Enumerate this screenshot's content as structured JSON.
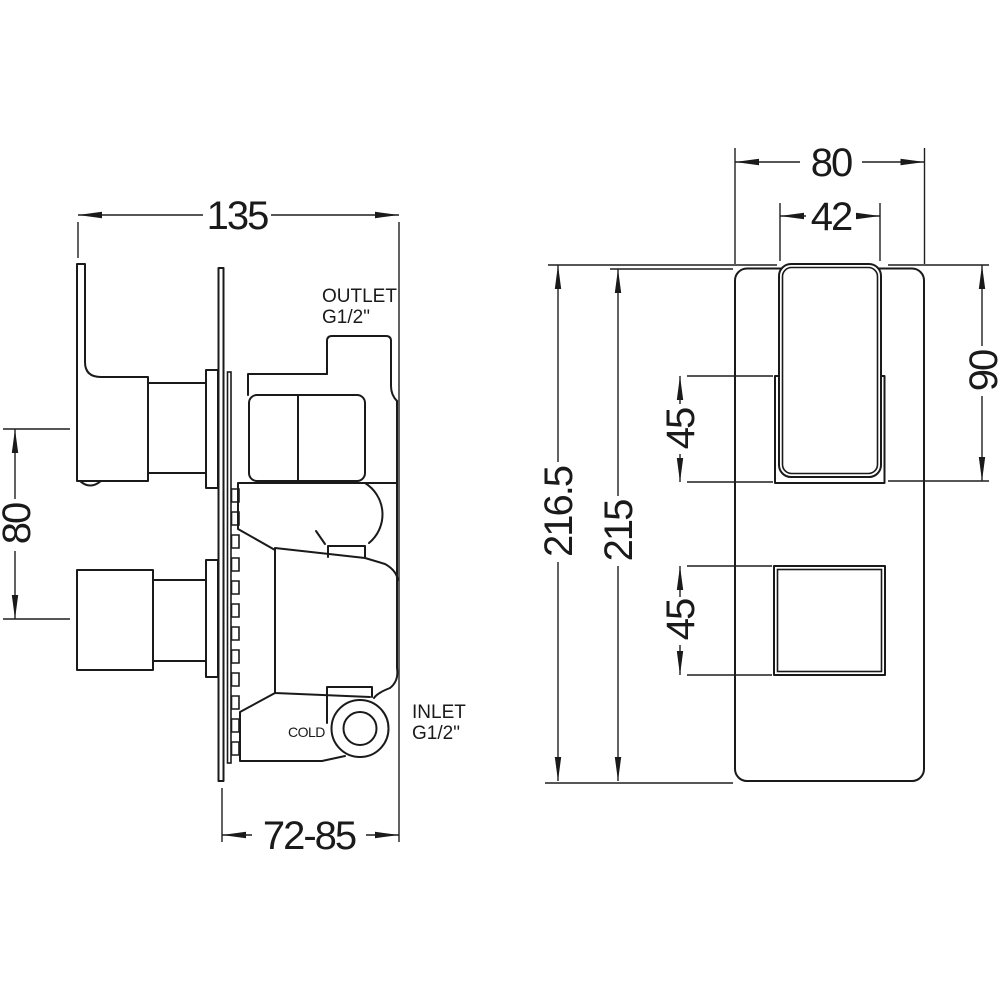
{
  "page": {
    "background": "#ffffff",
    "line_color": "#1a1a1a"
  },
  "side_view": {
    "dimensions": {
      "overall_depth": "135",
      "handle_spacing": "80",
      "recess_depth_range": "72-85"
    },
    "labels": {
      "outlet": "OUTLET",
      "outlet_thread": "G1/2\"",
      "inlet": "INLET",
      "inlet_thread": "G1/2\"",
      "cold": "COLD"
    }
  },
  "front_view": {
    "dimensions": {
      "plate_width": "80",
      "handle_width": "42",
      "handle_height": "90",
      "handle_recess_height": "45",
      "diverter_recess_height": "45",
      "overall_height": "216.5",
      "plate_height": "215"
    }
  }
}
